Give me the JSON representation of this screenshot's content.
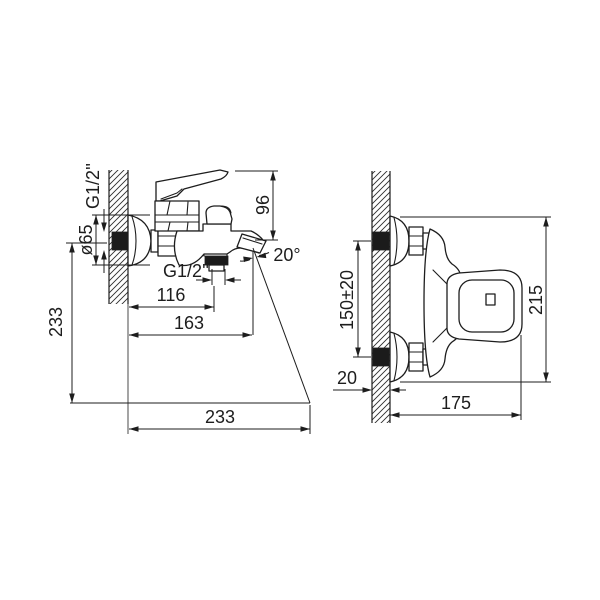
{
  "drawing": {
    "colors": {
      "ink": "#1d1d1d",
      "paper": "#ffffff",
      "fill_dark": "#1b1b1b"
    },
    "side_view": {
      "thread_top_label": "G1/2''",
      "escutcheon_diameter_label": "ø65",
      "height_label": "96",
      "spout_angle_label": "20°",
      "thread_bottom_label": "G1/2''",
      "wall_to_shower_outlet_label": "116",
      "wall_to_spout_tip_label": "163",
      "bottom_width_label": "233",
      "left_height_label": "233"
    },
    "front_view": {
      "hole_spacing_label": "150±20",
      "wall_depth_label": "20",
      "projection_label": "175",
      "overall_height_label": "215"
    }
  }
}
